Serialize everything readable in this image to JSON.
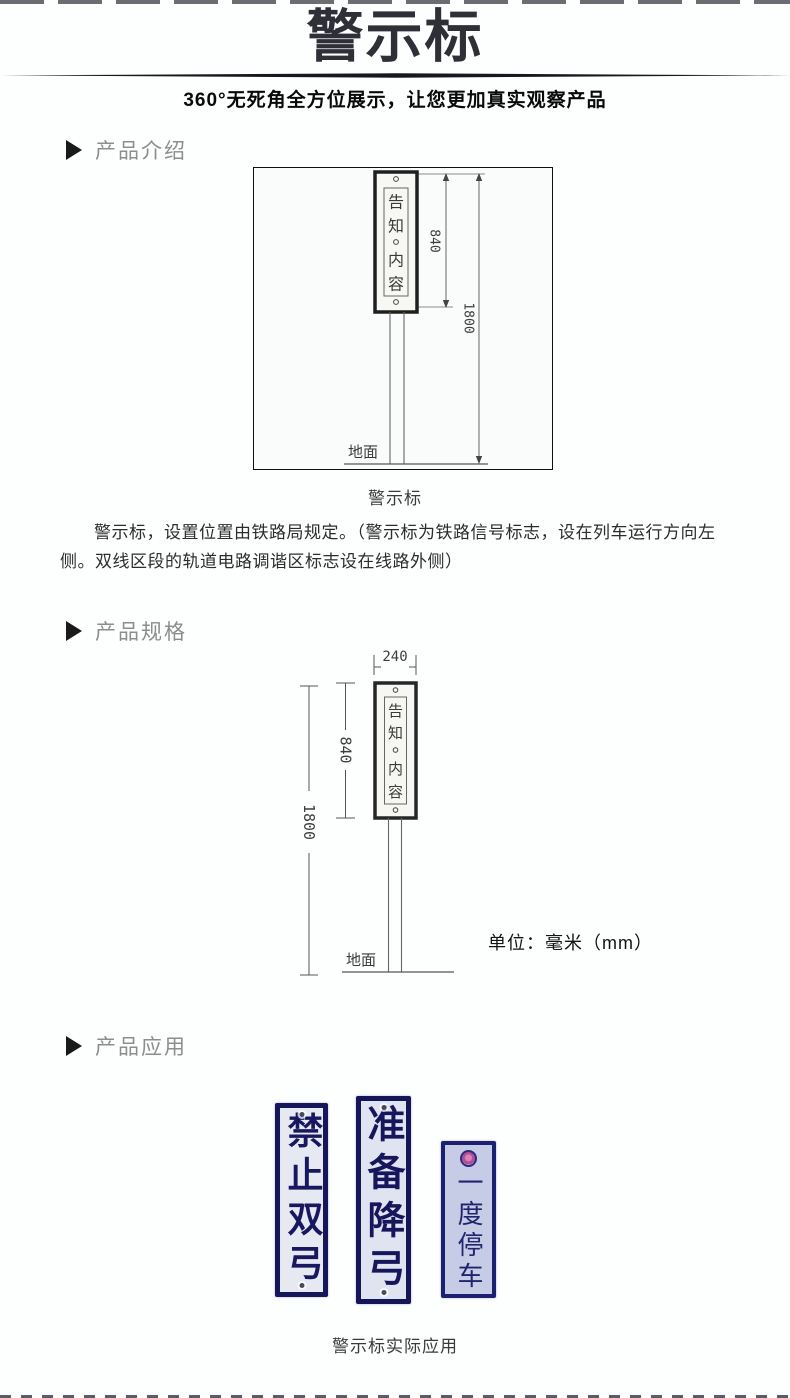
{
  "header": {
    "title": "警示标",
    "subtitle": "360°无死角全方位展示，让您更加真实观察产品"
  },
  "sections": {
    "intro_label": "产品介绍",
    "spec_label": "产品规格",
    "app_label": "产品应用"
  },
  "diagram_intro": {
    "sign_chars": [
      "告",
      "知",
      "内",
      "容"
    ],
    "dim_sign_height": "840",
    "dim_total_height": "1800",
    "ground_label": "地面",
    "caption": "警示标"
  },
  "intro_paragraph": "警示标，设置位置由铁路局规定。（警示标为铁路信号标志，设在列车运行方向左侧。双线区段的轨道电路调谐区标志设在线路外侧）",
  "diagram_spec": {
    "sign_chars": [
      "告",
      "知",
      "内",
      "容"
    ],
    "dim_width": "240",
    "dim_sign_height": "840",
    "dim_total_height": "1800",
    "ground_label": "地面",
    "unit_label": "单位：毫米（mm）"
  },
  "application": {
    "signs": [
      {
        "text": "禁止双弓"
      },
      {
        "text": "准备降弓"
      },
      {
        "text": "一度停车"
      }
    ],
    "caption": "警示标实际应用"
  },
  "colors": {
    "title_ink": "#2f2f38",
    "section_label_gray": "#8d8d8d",
    "sign_navy": "#16175a",
    "sign_plate_blue_white": "#e6e8f2",
    "emblem_pink": "#b44f96"
  }
}
